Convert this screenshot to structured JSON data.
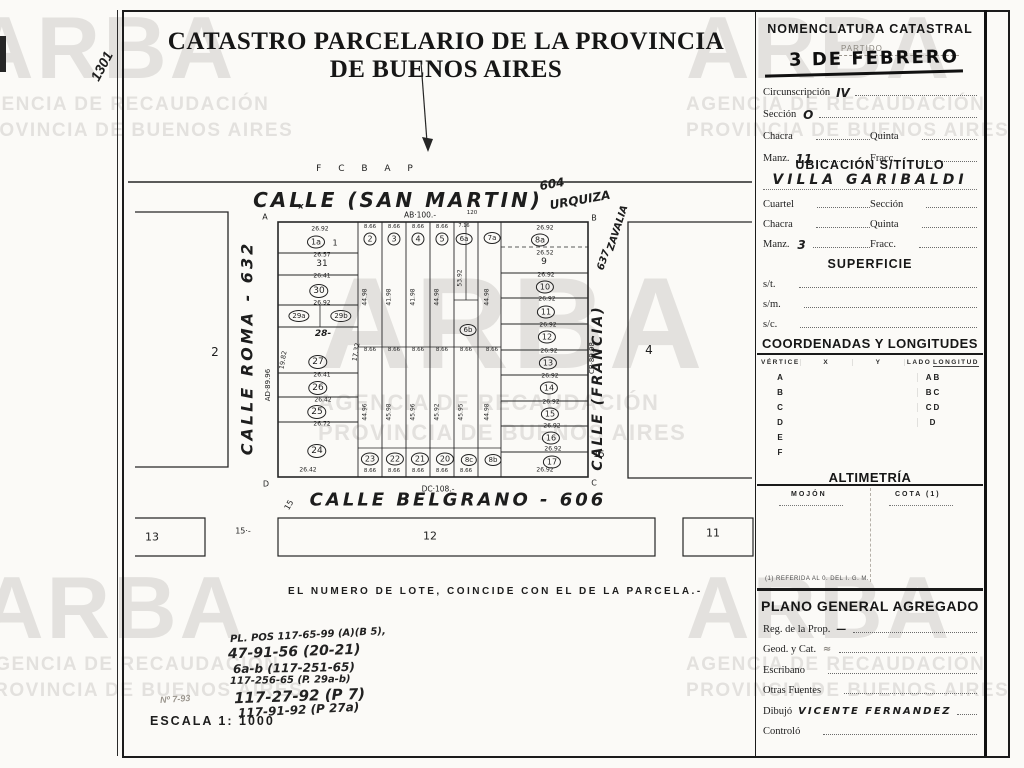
{
  "page": {
    "sheet_number": "1301",
    "title": "CATASTRO PARCELARIO DE LA PROVINCIA DE BUENOS AIRES",
    "note": "EL NUMERO DE LOTE, COINCIDE CON EL DE LA PARCELA.-",
    "scale_label": "ESCALA 1: 1000",
    "faint_ref": "Nº 7-93"
  },
  "watermark": {
    "brand": "ARBA",
    "line1": "AGENCIA DE RECAUDACIÓN",
    "line2": "PROVINCIA DE BUENOS AIRES"
  },
  "references": [
    {
      "t": "PL. POS 117-65-99 (A)(B 5),",
      "x": 230,
      "y": 630,
      "s": 10,
      "r": -3
    },
    {
      "t": "47-91-56 (20-21)",
      "x": 228,
      "y": 644,
      "s": 14,
      "r": -2
    },
    {
      "t": "6a-b (117-251-65)",
      "x": 233,
      "y": 661,
      "s": 12,
      "r": -1
    },
    {
      "t": "117-256-65 (P. 29a-b)",
      "x": 230,
      "y": 675,
      "s": 10,
      "r": -1
    },
    {
      "t": "117-27-92 (P 7)",
      "x": 234,
      "y": 687,
      "s": 15,
      "r": -2
    },
    {
      "t": "117-91-92 (P 27a)",
      "x": 238,
      "y": 703,
      "s": 12,
      "r": -3
    }
  ],
  "map": {
    "railway": "F C B A P",
    "labels": [
      {
        "t": "CALLE  (SAN  MARTIN)",
        "x": 398,
        "y": 200,
        "s": 20,
        "ls": 3,
        "cls": "hand"
      },
      {
        "t": "604",
        "x": 552,
        "y": 184,
        "s": 12,
        "r": -10,
        "cls": "hand"
      },
      {
        "t": "URQUIZA",
        "x": 580,
        "y": 200,
        "s": 12,
        "r": -10,
        "cls": "hand"
      },
      {
        "t": "ZAVALIA",
        "x": 618,
        "y": 228,
        "s": 10,
        "r": -72,
        "cls": "hand"
      },
      {
        "t": "637",
        "x": 604,
        "y": 260,
        "s": 10,
        "r": -72,
        "cls": "hand"
      },
      {
        "t": "CALLE ROMA - 632",
        "x": 247,
        "y": 348,
        "s": 16,
        "r": -90,
        "ls": 3,
        "cls": "hand"
      },
      {
        "t": "CALLE (FRANCIA)",
        "x": 598,
        "y": 388,
        "s": 14,
        "r": -90,
        "ls": 2,
        "cls": "hand"
      },
      {
        "t": "CALLE  BELGRANO - 606",
        "x": 458,
        "y": 500,
        "s": 18,
        "ls": 3,
        "cls": "hand"
      },
      {
        "t": "2",
        "x": 215,
        "y": 352,
        "s": 12
      },
      {
        "t": "4",
        "x": 649,
        "y": 350,
        "s": 12
      },
      {
        "t": "13",
        "x": 152,
        "y": 537,
        "s": 11
      },
      {
        "t": "12",
        "x": 430,
        "y": 536,
        "s": 11
      },
      {
        "t": "11",
        "x": 713,
        "y": 533,
        "s": 11
      },
      {
        "t": "15·-",
        "x": 243,
        "y": 531,
        "s": 8
      },
      {
        "t": "15",
        "x": 289,
        "y": 505,
        "s": 8,
        "r": -60
      },
      {
        "t": "15",
        "x": 599,
        "y": 455,
        "s": 9
      },
      {
        "t": "A",
        "x": 265,
        "y": 217,
        "s": 8
      },
      {
        "t": "B",
        "x": 594,
        "y": 218,
        "s": 8
      },
      {
        "t": "C",
        "x": 594,
        "y": 483,
        "s": 8
      },
      {
        "t": "D",
        "x": 266,
        "y": 484,
        "s": 8
      },
      {
        "t": "x",
        "x": 301,
        "y": 206,
        "s": 8,
        "cls": "hand"
      },
      {
        "t": "AB·100.-",
        "x": 420,
        "y": 215,
        "s": 7.5
      },
      {
        "t": "120",
        "x": 472,
        "y": 213,
        "s": 5.5
      },
      {
        "t": "DC·108.-",
        "x": 438,
        "y": 489,
        "s": 7.5
      },
      {
        "t": "AD·89.96",
        "x": 268,
        "y": 385,
        "s": 7,
        "r": -90
      },
      {
        "t": "CB·89.98",
        "x": 592,
        "y": 358,
        "s": 7,
        "r": -90
      },
      {
        "t": "19.82",
        "x": 283,
        "y": 360,
        "s": 6.5,
        "r": -80
      },
      {
        "t": "17.32",
        "x": 356,
        "y": 352,
        "s": 6.5,
        "r": -80
      },
      {
        "t": "1a",
        "x": 316,
        "y": 242,
        "s": 8,
        "cls": "circ"
      },
      {
        "t": "1",
        "x": 335,
        "y": 243,
        "s": 8
      },
      {
        "t": "26.92",
        "x": 320,
        "y": 229,
        "s": 6
      },
      {
        "t": "26.57",
        "x": 322,
        "y": 255,
        "s": 6
      },
      {
        "t": "31",
        "x": 322,
        "y": 264,
        "s": 9
      },
      {
        "t": "26.41",
        "x": 322,
        "y": 276,
        "s": 6
      },
      {
        "t": "30",
        "x": 319,
        "y": 291,
        "s": 9,
        "cls": "circ"
      },
      {
        "t": "26.92",
        "x": 322,
        "y": 303,
        "s": 6
      },
      {
        "t": "29a",
        "x": 299,
        "y": 316,
        "s": 7,
        "cls": "circ"
      },
      {
        "t": "29b",
        "x": 341,
        "y": 316,
        "s": 7,
        "cls": "circ"
      },
      {
        "t": "28-",
        "x": 323,
        "y": 334,
        "s": 9,
        "cls": "hand"
      },
      {
        "t": "27",
        "x": 318,
        "y": 362,
        "s": 9,
        "cls": "circ"
      },
      {
        "t": "26.41",
        "x": 322,
        "y": 375,
        "s": 6
      },
      {
        "t": "26",
        "x": 318,
        "y": 388,
        "s": 9,
        "cls": "circ"
      },
      {
        "t": "26.42",
        "x": 323,
        "y": 400,
        "s": 6
      },
      {
        "t": "25",
        "x": 317,
        "y": 412,
        "s": 9,
        "cls": "circ"
      },
      {
        "t": "26.72",
        "x": 322,
        "y": 424,
        "s": 6
      },
      {
        "t": "24",
        "x": 317,
        "y": 451,
        "s": 9,
        "cls": "circ"
      },
      {
        "t": "26.42",
        "x": 308,
        "y": 470,
        "s": 6
      },
      {
        "t": "8.66",
        "x": 370,
        "y": 227,
        "s": 5.5
      },
      {
        "t": "8.66",
        "x": 394,
        "y": 227,
        "s": 5.5
      },
      {
        "t": "8.66",
        "x": 418,
        "y": 227,
        "s": 5.5
      },
      {
        "t": "8.66",
        "x": 442,
        "y": 227,
        "s": 5.5
      },
      {
        "t": "7.16",
        "x": 464,
        "y": 226,
        "s": 5
      },
      {
        "t": "2",
        "x": 370,
        "y": 239,
        "s": 8,
        "cls": "circ"
      },
      {
        "t": "3",
        "x": 394,
        "y": 239,
        "s": 8,
        "cls": "circ"
      },
      {
        "t": "4",
        "x": 418,
        "y": 239,
        "s": 8,
        "cls": "circ"
      },
      {
        "t": "5",
        "x": 442,
        "y": 239,
        "s": 8,
        "cls": "circ"
      },
      {
        "t": "6a",
        "x": 464,
        "y": 239,
        "s": 7,
        "cls": "circ"
      },
      {
        "t": "7a",
        "x": 492,
        "y": 238,
        "s": 7,
        "cls": "circ"
      },
      {
        "t": "6b",
        "x": 468,
        "y": 330,
        "s": 7,
        "cls": "circ"
      },
      {
        "t": "44.98",
        "x": 365,
        "y": 297,
        "s": 6,
        "r": -90
      },
      {
        "t": "41.98",
        "x": 389,
        "y": 297,
        "s": 6,
        "r": -90
      },
      {
        "t": "41.98",
        "x": 413,
        "y": 297,
        "s": 6,
        "r": -90
      },
      {
        "t": "44.98",
        "x": 437,
        "y": 297,
        "s": 6,
        "r": -90
      },
      {
        "t": "53.92",
        "x": 460,
        "y": 278,
        "s": 6,
        "r": -90
      },
      {
        "t": "44.98",
        "x": 487,
        "y": 297,
        "s": 6,
        "r": -90
      },
      {
        "t": "8.66",
        "x": 370,
        "y": 350,
        "s": 5.5
      },
      {
        "t": "8.66",
        "x": 394,
        "y": 350,
        "s": 5.5
      },
      {
        "t": "8.66",
        "x": 418,
        "y": 350,
        "s": 5.5
      },
      {
        "t": "8.66",
        "x": 442,
        "y": 350,
        "s": 5.5
      },
      {
        "t": "8.66",
        "x": 466,
        "y": 350,
        "s": 5.5
      },
      {
        "t": "8.66",
        "x": 492,
        "y": 350,
        "s": 5.5
      },
      {
        "t": "44.96",
        "x": 365,
        "y": 412,
        "s": 6,
        "r": -90
      },
      {
        "t": "45.98",
        "x": 389,
        "y": 412,
        "s": 6,
        "r": -90
      },
      {
        "t": "45.96",
        "x": 413,
        "y": 412,
        "s": 6,
        "r": -90
      },
      {
        "t": "45.92",
        "x": 437,
        "y": 412,
        "s": 6,
        "r": -90
      },
      {
        "t": "45.95",
        "x": 461,
        "y": 412,
        "s": 6,
        "r": -90
      },
      {
        "t": "44.98",
        "x": 487,
        "y": 412,
        "s": 6,
        "r": -90
      },
      {
        "t": "23",
        "x": 370,
        "y": 459,
        "s": 8,
        "cls": "circ"
      },
      {
        "t": "22",
        "x": 395,
        "y": 459,
        "s": 8,
        "cls": "circ"
      },
      {
        "t": "21",
        "x": 420,
        "y": 459,
        "s": 8,
        "cls": "circ"
      },
      {
        "t": "20",
        "x": 445,
        "y": 459,
        "s": 8,
        "cls": "circ"
      },
      {
        "t": "8c",
        "x": 469,
        "y": 460,
        "s": 7,
        "cls": "circ"
      },
      {
        "t": "8b",
        "x": 493,
        "y": 460,
        "s": 7,
        "cls": "circ"
      },
      {
        "t": "8.66",
        "x": 370,
        "y": 471,
        "s": 5.5
      },
      {
        "t": "8.66",
        "x": 394,
        "y": 471,
        "s": 5.5
      },
      {
        "t": "8.66",
        "x": 418,
        "y": 471,
        "s": 5.5
      },
      {
        "t": "8.66",
        "x": 442,
        "y": 471,
        "s": 5.5
      },
      {
        "t": "8.66",
        "x": 466,
        "y": 471,
        "s": 5.5
      },
      {
        "t": "26.92",
        "x": 545,
        "y": 470,
        "s": 6
      },
      {
        "t": "8a",
        "x": 540,
        "y": 240,
        "s": 8,
        "cls": "circ"
      },
      {
        "t": "26.92",
        "x": 545,
        "y": 228,
        "s": 6
      },
      {
        "t": "26.52",
        "x": 545,
        "y": 253,
        "s": 6
      },
      {
        "t": "9",
        "x": 544,
        "y": 262,
        "s": 9
      },
      {
        "t": "26.92",
        "x": 546,
        "y": 275,
        "s": 6
      },
      {
        "t": "10",
        "x": 545,
        "y": 287,
        "s": 8,
        "cls": "circ"
      },
      {
        "t": "26.92",
        "x": 547,
        "y": 299,
        "s": 6
      },
      {
        "t": "11",
        "x": 546,
        "y": 312,
        "s": 8,
        "cls": "circ"
      },
      {
        "t": "26.92",
        "x": 548,
        "y": 325,
        "s": 6
      },
      {
        "t": "12",
        "x": 547,
        "y": 337,
        "s": 8,
        "cls": "circ"
      },
      {
        "t": "26.92",
        "x": 549,
        "y": 351,
        "s": 6
      },
      {
        "t": "13",
        "x": 548,
        "y": 363,
        "s": 8,
        "cls": "circ"
      },
      {
        "t": "26.92",
        "x": 550,
        "y": 376,
        "s": 6
      },
      {
        "t": "14",
        "x": 549,
        "y": 388,
        "s": 8,
        "cls": "circ"
      },
      {
        "t": "26.92",
        "x": 551,
        "y": 402,
        "s": 6
      },
      {
        "t": "15",
        "x": 550,
        "y": 414,
        "s": 8,
        "cls": "circ"
      },
      {
        "t": "26.92",
        "x": 552,
        "y": 426,
        "s": 6
      },
      {
        "t": "16",
        "x": 551,
        "y": 438,
        "s": 8,
        "cls": "circ"
      },
      {
        "t": "26.92",
        "x": 553,
        "y": 449,
        "s": 6
      },
      {
        "t": "17",
        "x": 552,
        "y": 462,
        "s": 8,
        "cls": "circ"
      }
    ]
  },
  "panel": {
    "nomenclatura": {
      "title": "NOMENCLATURA CATASTRAL",
      "partido_label": "PARTIDO",
      "stamp": "3 DE FEBRERO",
      "rows": [
        [
          {
            "label": "Circunscripción",
            "value": "IV"
          }
        ],
        [
          {
            "label": "Sección",
            "value": "O"
          }
        ],
        [
          {
            "label": "Chacra",
            "value": ""
          },
          {
            "label": "Quinta",
            "value": ""
          }
        ],
        [
          {
            "label": "Manz.",
            "value": "11"
          },
          {
            "label": "Fracc.",
            "value": ""
          }
        ]
      ]
    },
    "ubicacion": {
      "title": "UBICACIÓN S/TÍTULO",
      "value": "VILLA GARIBALDI",
      "rows": [
        [
          {
            "label": "Cuartel",
            "value": ""
          },
          {
            "label": "Sección",
            "value": ""
          }
        ],
        [
          {
            "label": "Chacra",
            "value": ""
          },
          {
            "label": "Quinta",
            "value": ""
          }
        ],
        [
          {
            "label": "Manz.",
            "value": "3"
          },
          {
            "label": "Fracc.",
            "value": ""
          }
        ]
      ]
    },
    "superficie": {
      "title": "SUPERFICIE",
      "rows": [
        [
          {
            "label": "s/t.",
            "value": ""
          }
        ],
        [
          {
            "label": "s/m.",
            "value": ""
          }
        ],
        [
          {
            "label": "s/c.",
            "value": ""
          }
        ]
      ]
    },
    "coordenadas": {
      "title": "COORDENADAS Y LONGITUDES",
      "headers": [
        "VÉRTICE",
        "X",
        "Y",
        "LADO",
        "LONGITUD"
      ],
      "rows": [
        {
          "vertice": "A",
          "x": "",
          "y": "",
          "lado": "AB",
          "longitud": ""
        },
        {
          "vertice": "B",
          "x": "",
          "y": "",
          "lado": "BC",
          "longitud": ""
        },
        {
          "vertice": "C",
          "x": "",
          "y": "",
          "lado": "CD",
          "longitud": ""
        },
        {
          "vertice": "D",
          "x": "",
          "y": "",
          "lado": "D",
          "longitud": ""
        },
        {
          "vertice": "E",
          "x": "",
          "y": "",
          "lado": "",
          "longitud": ""
        },
        {
          "vertice": "F",
          "x": "",
          "y": "",
          "lado": "",
          "longitud": ""
        }
      ]
    },
    "altimetria": {
      "title": "ALTIMETRÍA",
      "col1": "MOJÓN",
      "col2": "COTA (1)",
      "footnote": "(1) REFERIDA AL 0. DEL I. G. M."
    },
    "plano": {
      "title": "PLANO GENERAL AGREGADO",
      "rows": [
        [
          {
            "label": "Reg. de la Prop.",
            "value": "—"
          }
        ],
        [
          {
            "label": "Geod. y Cat.",
            "value": "≈",
            "faint": true
          }
        ],
        [
          {
            "label": "Escribano",
            "value": ""
          }
        ],
        [
          {
            "label": "Otras Fuentes",
            "value": ""
          }
        ],
        [
          {
            "label": "Dibujó",
            "value": "VICENTE FERNANDEZ"
          }
        ],
        [
          {
            "label": "Controló",
            "value": ""
          }
        ]
      ]
    }
  }
}
